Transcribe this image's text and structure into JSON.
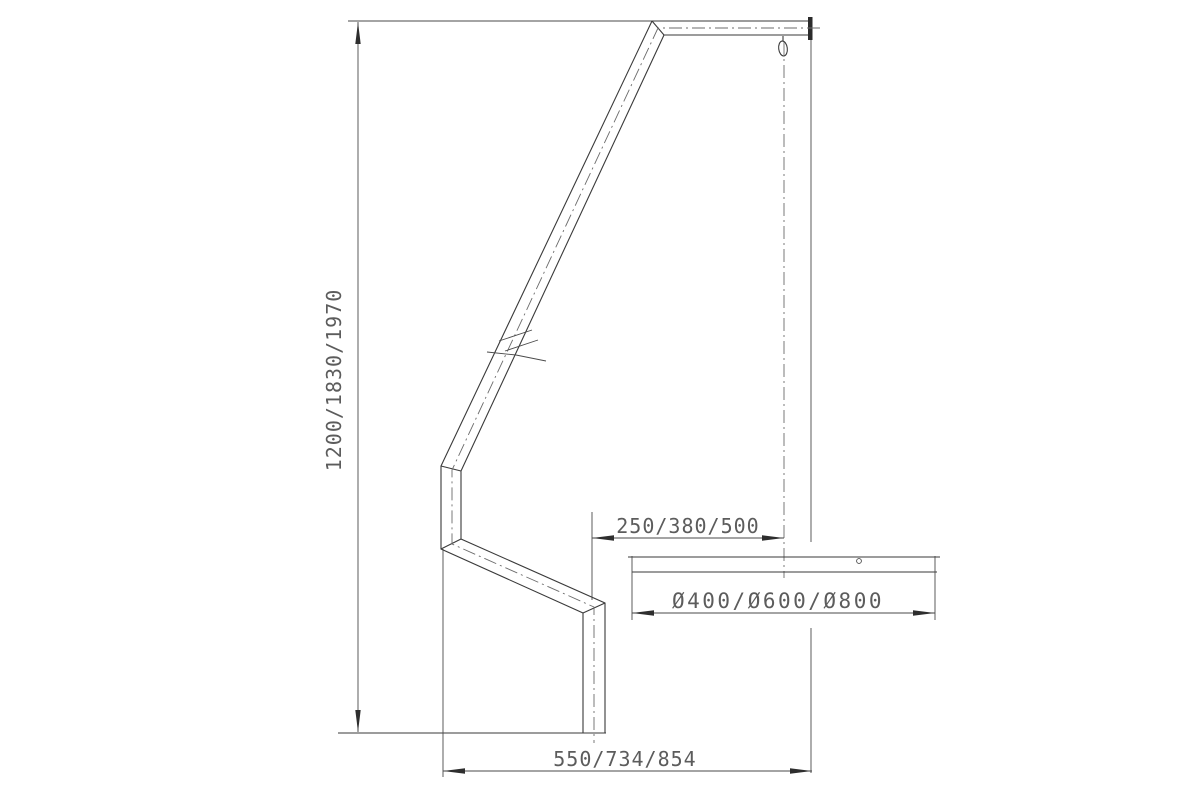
{
  "drawing": {
    "type": "technical-drawing",
    "subject": "bent pole stand with hook and round base plate, side view",
    "labels": {
      "height_dim": "1200/1830/1970",
      "offset_dim": "250/380/500",
      "base_diameter_dim": "Ø400/Ø600/Ø800",
      "footprint_dim": "550/734/854"
    },
    "colors": {
      "background": "#ffffff",
      "outline": "#3a3a3a",
      "thin_line": "#4a4a4a",
      "centerline": "#6b6b6b",
      "arrow": "#2e2e2e",
      "text": "#5c5c5c"
    }
  }
}
